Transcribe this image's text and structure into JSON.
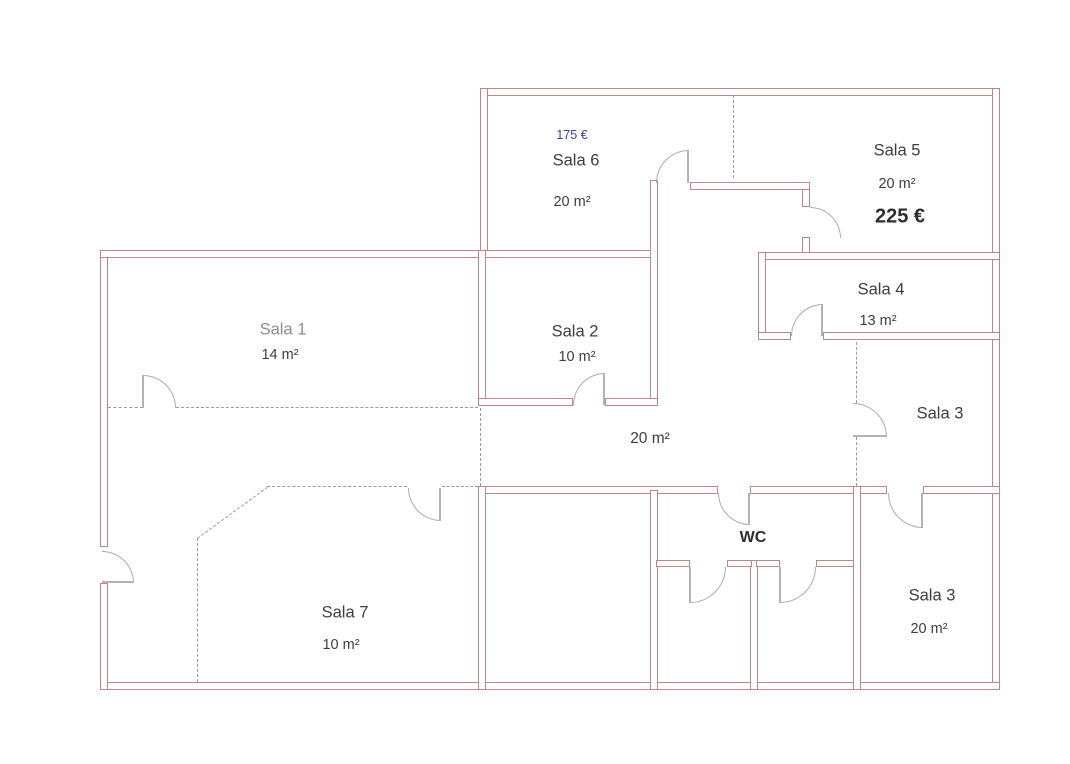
{
  "rooms": {
    "sala1": {
      "name": "Sala 1",
      "area": "14 m²"
    },
    "sala2": {
      "name": "Sala 2",
      "area": "10 m²"
    },
    "sala3_middle": {
      "name": "Sala 3"
    },
    "sala3_bottom": {
      "name": "Sala 3",
      "area": "20 m²"
    },
    "sala4": {
      "name": "Sala 4",
      "area": "13 m²"
    },
    "sala5": {
      "name": "Sala 5",
      "area": "20 m²",
      "price": "225 €"
    },
    "sala6": {
      "name": "Sala 6",
      "area": "20 m²",
      "price": "175 €"
    },
    "sala7": {
      "name": "Sala 7",
      "area": "10 m²"
    },
    "wc": {
      "name": "WC"
    },
    "corridor": {
      "area": "20 m²"
    }
  },
  "colors": {
    "wall": "#c08585",
    "door_arc": "#ababab",
    "dashed_line": "#9a9a9a",
    "text": "#3d3d3d",
    "price_blue": "#3a3f9f"
  }
}
